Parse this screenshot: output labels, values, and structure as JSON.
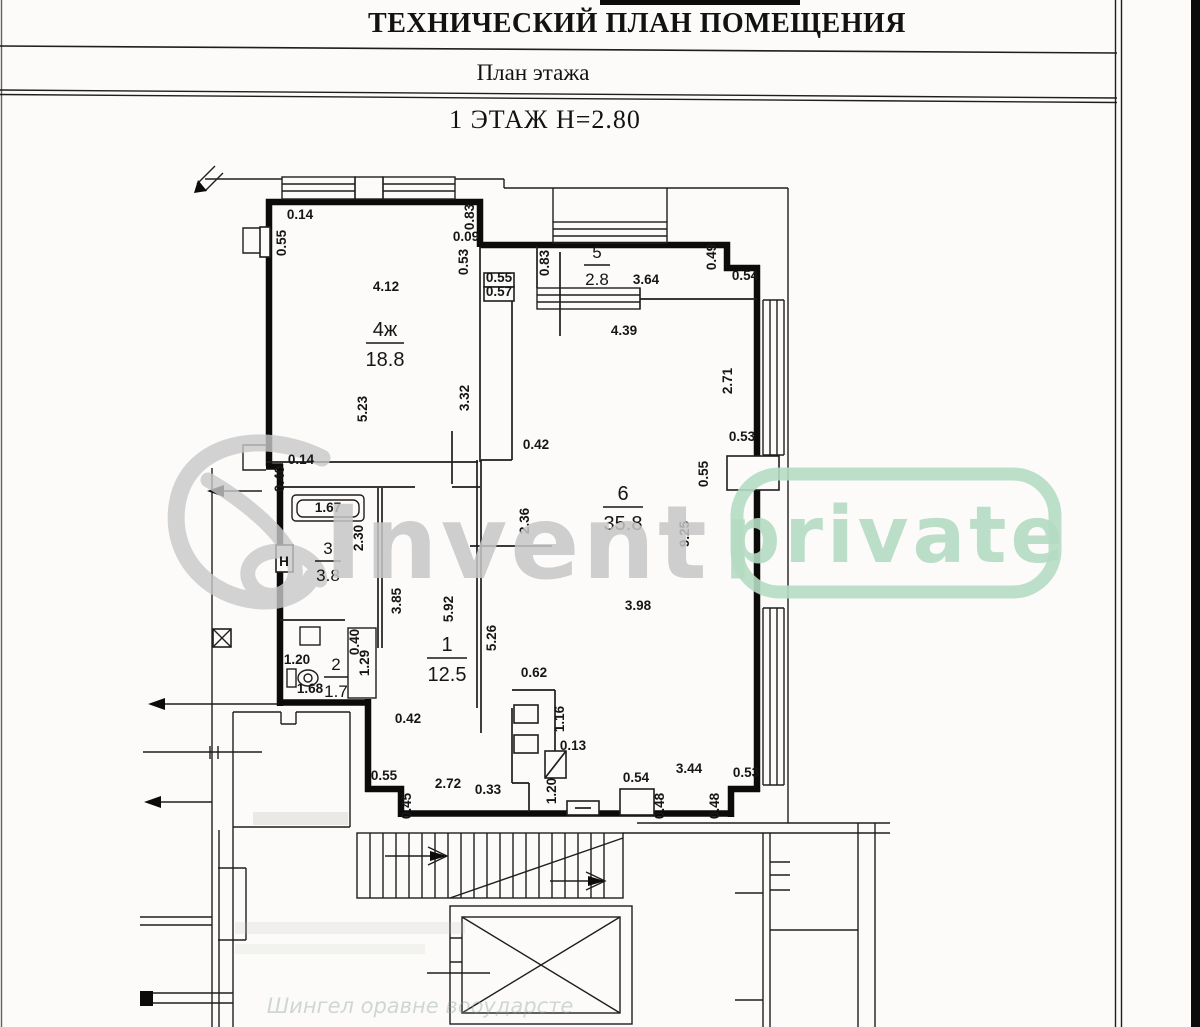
{
  "header": {
    "title": "ТЕХНИЧЕСКИЙ ПЛАН ПОМЕЩЕНИЯ",
    "subtitle": "План этажа",
    "floor_line": "1 ЭТАЖ Н=2.80"
  },
  "watermark": {
    "brand": "Invent",
    "badge": "private",
    "brand_color": "#c7c7c7",
    "badge_color": "#b5dbc3",
    "logo_color": "#c9c9c9"
  },
  "plan": {
    "rooms": [
      {
        "num": "4ж",
        "area": "18.8",
        "x": 385,
        "y": 336,
        "w": 38,
        "s": 20
      },
      {
        "num": "5",
        "area": "2.8",
        "x": 597,
        "y": 258,
        "w": 26,
        "s": 17
      },
      {
        "num": "6",
        "area": "35.8",
        "x": 623,
        "y": 500,
        "w": 40,
        "s": 20
      },
      {
        "num": "3",
        "area": "3.8",
        "x": 328,
        "y": 554,
        "w": 26,
        "s": 17
      },
      {
        "num": "1",
        "area": "12.5",
        "x": 447,
        "y": 651,
        "w": 40,
        "s": 20
      },
      {
        "num": "2",
        "area": "1.7",
        "x": 336,
        "y": 670,
        "w": 24,
        "s": 17
      }
    ],
    "dims": [
      {
        "t": "0.14",
        "x": 300,
        "y": 219,
        "r": 0
      },
      {
        "t": "0.55",
        "x": 286,
        "y": 243,
        "r": 90
      },
      {
        "t": "4.12",
        "x": 386,
        "y": 291,
        "r": 0
      },
      {
        "t": "5.23",
        "x": 367,
        "y": 409,
        "r": 90
      },
      {
        "t": "3.32",
        "x": 469,
        "y": 398,
        "r": 90
      },
      {
        "t": "0.83",
        "x": 474,
        "y": 217,
        "r": 90
      },
      {
        "t": "0.09",
        "x": 466,
        "y": 241,
        "r": 0
      },
      {
        "t": "0.53",
        "x": 468,
        "y": 262,
        "r": 90
      },
      {
        "t": "0.55",
        "x": 499,
        "y": 282,
        "r": 0
      },
      {
        "t": "0.57",
        "x": 499,
        "y": 296,
        "r": 0
      },
      {
        "t": "0.83",
        "x": 549,
        "y": 263,
        "r": 90
      },
      {
        "t": "3.64",
        "x": 646,
        "y": 284,
        "r": 0
      },
      {
        "t": "0.49",
        "x": 716,
        "y": 257,
        "r": 90
      },
      {
        "t": "0.54",
        "x": 745,
        "y": 280,
        "r": 0
      },
      {
        "t": "4.39",
        "x": 624,
        "y": 335,
        "r": 0
      },
      {
        "t": "2.71",
        "x": 732,
        "y": 381,
        "r": 90
      },
      {
        "t": "0.42",
        "x": 536,
        "y": 449,
        "r": 0
      },
      {
        "t": "0.53",
        "x": 742,
        "y": 441,
        "r": 0
      },
      {
        "t": "0.55",
        "x": 708,
        "y": 474,
        "r": 90
      },
      {
        "t": "9.25",
        "x": 689,
        "y": 534,
        "r": 90
      },
      {
        "t": "2.36",
        "x": 529,
        "y": 521,
        "r": 90
      },
      {
        "t": "3.98",
        "x": 638,
        "y": 610,
        "r": 0
      },
      {
        "t": "5.26",
        "x": 496,
        "y": 638,
        "r": 90
      },
      {
        "t": "0.62",
        "x": 534,
        "y": 677,
        "r": 0
      },
      {
        "t": "0.14",
        "x": 301,
        "y": 464,
        "r": 0
      },
      {
        "t": "0.40",
        "x": 284,
        "y": 479,
        "r": 90
      },
      {
        "t": "1.67",
        "x": 328,
        "y": 512,
        "r": 0
      },
      {
        "t": "2.30",
        "x": 363,
        "y": 538,
        "r": 90
      },
      {
        "t": "3.85",
        "x": 401,
        "y": 601,
        "r": 90
      },
      {
        "t": "5.92",
        "x": 453,
        "y": 609,
        "r": 90
      },
      {
        "t": "0.40",
        "x": 359,
        "y": 642,
        "r": 90
      },
      {
        "t": "1.29",
        "x": 369,
        "y": 663,
        "r": 90
      },
      {
        "t": "1.20",
        "x": 297,
        "y": 664,
        "r": 0
      },
      {
        "t": "1.68",
        "x": 310,
        "y": 693,
        "r": 0
      },
      {
        "t": "0.42",
        "x": 408,
        "y": 723,
        "r": 0
      },
      {
        "t": "0.55",
        "x": 384,
        "y": 780,
        "r": 0
      },
      {
        "t": "2.72",
        "x": 448,
        "y": 788,
        "r": 0
      },
      {
        "t": "0.33",
        "x": 488,
        "y": 794,
        "r": 0
      },
      {
        "t": "0.45",
        "x": 411,
        "y": 806,
        "r": 90
      },
      {
        "t": "1.16",
        "x": 564,
        "y": 719,
        "r": 90
      },
      {
        "t": "0.13",
        "x": 573,
        "y": 750,
        "r": 0
      },
      {
        "t": "1.20",
        "x": 556,
        "y": 791,
        "r": 90
      },
      {
        "t": "0.54",
        "x": 636,
        "y": 782,
        "r": 0
      },
      {
        "t": "3.44",
        "x": 689,
        "y": 773,
        "r": 0
      },
      {
        "t": "0.53",
        "x": 746,
        "y": 777,
        "r": 0
      },
      {
        "t": "0.48",
        "x": 664,
        "y": 806,
        "r": 90
      },
      {
        "t": "0.48",
        "x": 719,
        "y": 806,
        "r": 90
      },
      {
        "t": "Н",
        "x": 284,
        "y": 566,
        "r": 0
      }
    ],
    "faint": {
      "stamp": "Шингел оравне вооударсте"
    }
  }
}
